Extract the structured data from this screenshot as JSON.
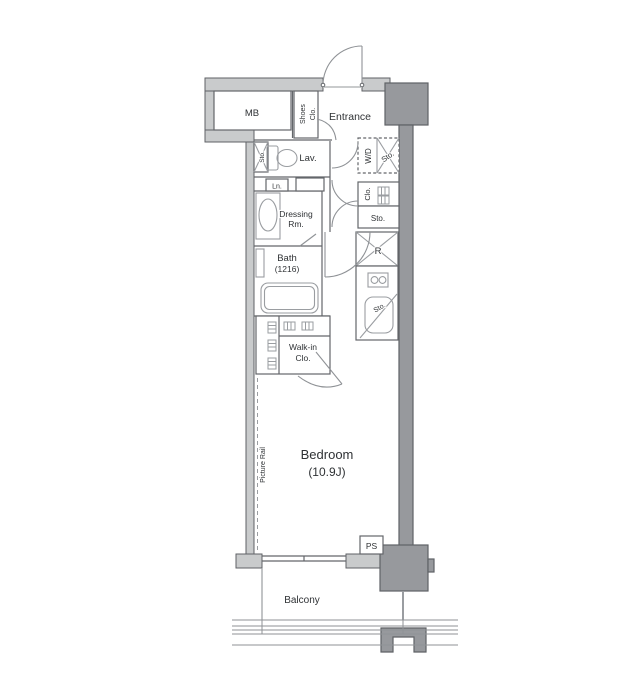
{
  "plan": {
    "type": "apartment-floor-plan",
    "labels": {
      "mb": "MB",
      "shoes_line1": "Shoes",
      "shoes_line2": "Clo.",
      "entrance": "Entrance",
      "lav": "Lav.",
      "lav_storage": "Sto.",
      "wd": "W/D",
      "wd_storage": "Sto.",
      "linen": "Ln.",
      "dressing_line1": "Dressing",
      "dressing_line2": "Rm.",
      "closet": "Clo.",
      "storage": "Sto.",
      "bath_line1": "Bath",
      "bath_line2": "(1216)",
      "refrigerator": "R",
      "sink_storage": "Sto.",
      "walkin_line1": "Walk-in",
      "walkin_line2": "Clo.",
      "bedroom_line1": "Bedroom",
      "bedroom_line2": "(10.9J)",
      "picture_rail": "Picture Rail",
      "ps": "PS",
      "balcony": "Balcony"
    },
    "colors": {
      "background": "#ffffff",
      "wall_fill": "#c9cbcc",
      "column_fill": "#97999d",
      "wall_stroke": "#5f6266",
      "line": "#63666a",
      "fixture": "#9a9da1",
      "text": "#2f3235"
    }
  }
}
